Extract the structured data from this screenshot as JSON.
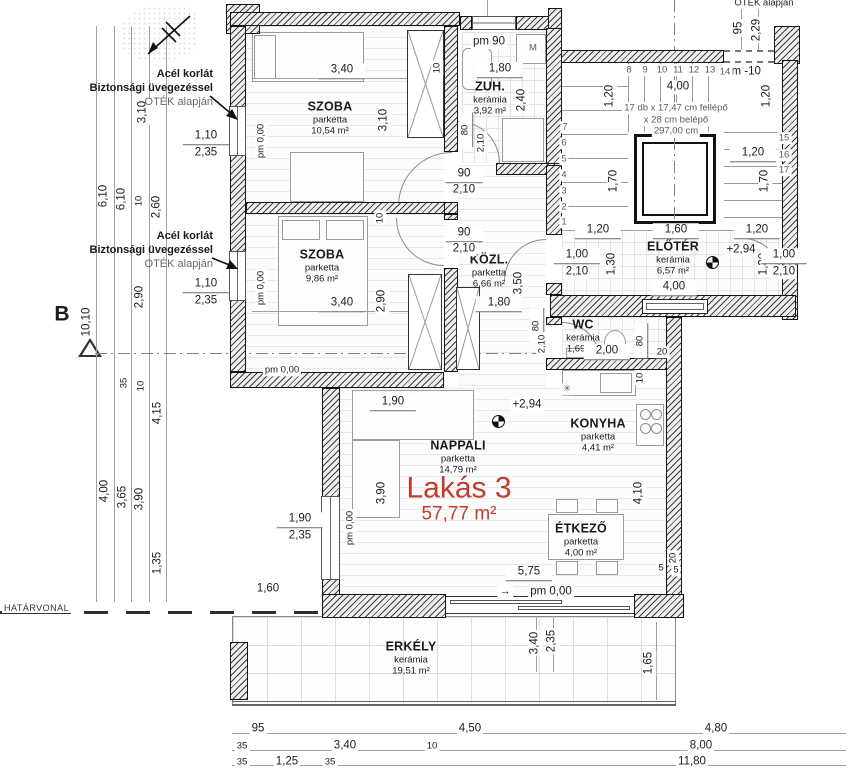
{
  "plan": {
    "unit_label": "Lakás 3",
    "unit_area": "57,77 m²",
    "accent_color": "#c13b2e"
  },
  "rooms": [
    {
      "name": "SZOBA",
      "material": "parketta",
      "area": "10,54 m²"
    },
    {
      "name": "ZUH.",
      "material": "kerámia",
      "area": "3,92 m²"
    },
    {
      "name": "SZOBA",
      "material": "parketta",
      "area": "9,86 m²"
    },
    {
      "name": "KÖZL.",
      "material": "parketta",
      "area": "6,66 m²"
    },
    {
      "name": "ELŐTÉR",
      "material": "kerámia",
      "area": "6,57 m²"
    },
    {
      "name": "WC",
      "material": "kerámia",
      "area": "1,69 m²"
    },
    {
      "name": "NAPPALI",
      "material": "parketta",
      "area": "14,79 m²"
    },
    {
      "name": "KONYHA",
      "material": "parketta",
      "area": "4,41 m²"
    },
    {
      "name": "ÉTKEZŐ",
      "material": "parketta",
      "area": "4,00 m²"
    },
    {
      "name": "ERKÉLY",
      "material": "kerámia",
      "area": "19,51 m²"
    }
  ],
  "annotations": {
    "railing_note_top": {
      "l1": "Acél korlát",
      "l2": "Biztonsági üvegezéssel",
      "l3": "OTÉK alapján"
    },
    "railing_note_mid": {
      "l1": "Acél korlát",
      "l2": "Biztonsági üvegezéssel",
      "l3": "OTÉK alapján"
    },
    "boundary_line": "HATÁRVONAL",
    "corner_note": "OTÉK alapján"
  },
  "dims": [
    {
      "t": "3,10",
      "x": 143,
      "y": 112,
      "r": 1
    },
    {
      "t": "6,10",
      "x": 104,
      "y": 196,
      "r": 1
    },
    {
      "t": "6,10",
      "x": 122,
      "y": 199,
      "r": 1
    },
    {
      "t": "10",
      "x": 139,
      "y": 201,
      "r": 1,
      "s": 1
    },
    {
      "t": "2,60",
      "x": 157,
      "y": 207,
      "r": 1
    },
    {
      "t": "2,90",
      "x": 140,
      "y": 297,
      "r": 1
    },
    {
      "t": "10,10",
      "x": 87,
      "y": 322,
      "r": 1
    },
    {
      "t": "B",
      "x": 62,
      "y": 314,
      "b": 1
    },
    {
      "t": "35",
      "x": 124,
      "y": 383,
      "r": 1,
      "s": 1
    },
    {
      "t": "10",
      "x": 141,
      "y": 386,
      "r": 1,
      "s": 1
    },
    {
      "t": "4,15",
      "x": 158,
      "y": 413,
      "r": 1
    },
    {
      "t": "4,00",
      "x": 105,
      "y": 491,
      "r": 1
    },
    {
      "t": "3,65",
      "x": 123,
      "y": 497,
      "r": 1
    },
    {
      "t": "3,90",
      "x": 140,
      "y": 499,
      "r": 1
    },
    {
      "t": "1,35",
      "x": 158,
      "y": 563,
      "r": 1
    },
    {
      "t": "1,60",
      "x": 268,
      "y": 589
    },
    {
      "t": "1,10",
      "x": 206,
      "y": 137,
      "u": 1
    },
    {
      "t": "2,35",
      "x": 206,
      "y": 153
    },
    {
      "t": "1,10",
      "x": 206,
      "y": 285,
      "u": 1
    },
    {
      "t": "2,35",
      "x": 206,
      "y": 301
    },
    {
      "t": "pm 0,00",
      "x": 261,
      "y": 141,
      "r": 1,
      "s": 1
    },
    {
      "t": "pm 0,00",
      "x": 261,
      "y": 288,
      "r": 1,
      "s": 1
    },
    {
      "t": "pm 0,00",
      "x": 282,
      "y": 370,
      "s": 1
    },
    {
      "t": "pm 0,00",
      "x": 350,
      "y": 528,
      "r": 1,
      "s": 1
    },
    {
      "t": "3,40",
      "x": 342,
      "y": 71,
      "u": 1
    },
    {
      "t": "3,10",
      "x": 384,
      "y": 120,
      "r": 1
    },
    {
      "t": "10",
      "x": 437,
      "y": 68,
      "r": 1,
      "s": 1
    },
    {
      "t": "pm 90",
      "x": 489,
      "y": 42
    },
    {
      "t": "M",
      "x": 533,
      "y": 48,
      "s": 1,
      "g": 1
    },
    {
      "t": "1,80",
      "x": 500,
      "y": 70,
      "u": 1
    },
    {
      "t": "2,40",
      "x": 522,
      "y": 100,
      "r": 1
    },
    {
      "t": "80",
      "x": 466,
      "y": 130,
      "r": 1,
      "s": 1,
      "u": 1
    },
    {
      "t": "2,10",
      "x": 481,
      "y": 143,
      "r": 1,
      "s": 1
    },
    {
      "t": "90",
      "x": 464,
      "y": 175,
      "u": 1
    },
    {
      "t": "2,10",
      "x": 464,
      "y": 190
    },
    {
      "t": "95",
      "x": 739,
      "y": 28,
      "r": 1
    },
    {
      "t": "2,29",
      "x": 757,
      "y": 30,
      "r": 1
    },
    {
      "t": "OTÉK alapján",
      "x": 764,
      "y": 3,
      "s": 1
    },
    {
      "t": "pm -10",
      "x": 743,
      "y": 72
    },
    {
      "t": "4,00",
      "x": 678,
      "y": 87
    },
    {
      "t": "1,20",
      "x": 610,
      "y": 96,
      "r": 1
    },
    {
      "t": "1,20",
      "x": 767,
      "y": 96,
      "r": 1
    },
    {
      "t": "17 db x 17,47 cm fellépő",
      "x": 676,
      "y": 108,
      "s": 1,
      "g": 1
    },
    {
      "t": "x 28 cm belépő",
      "x": 676,
      "y": 120,
      "s": 1,
      "g": 1
    },
    {
      "t": "297,00 cm",
      "x": 676,
      "y": 131,
      "s": 1,
      "g": 1
    },
    {
      "t": "8",
      "x": 629,
      "y": 70,
      "s": 1,
      "g": 1
    },
    {
      "t": "9",
      "x": 645,
      "y": 70,
      "s": 1,
      "g": 1
    },
    {
      "t": "10",
      "x": 662,
      "y": 70,
      "s": 1,
      "g": 1
    },
    {
      "t": "11",
      "x": 678,
      "y": 70,
      "s": 1,
      "g": 1
    },
    {
      "t": "12",
      "x": 694,
      "y": 70,
      "s": 1,
      "g": 1
    },
    {
      "t": "13",
      "x": 710,
      "y": 70,
      "s": 1,
      "g": 1
    },
    {
      "t": "14",
      "x": 725,
      "y": 72,
      "s": 1,
      "g": 1
    },
    {
      "t": "7",
      "x": 565,
      "y": 127,
      "s": 1,
      "g": 1
    },
    {
      "t": "6",
      "x": 564,
      "y": 143,
      "s": 1,
      "g": 1
    },
    {
      "t": "5",
      "x": 564,
      "y": 159,
      "s": 1,
      "g": 1
    },
    {
      "t": "4",
      "x": 564,
      "y": 175,
      "s": 1,
      "g": 1
    },
    {
      "t": "3",
      "x": 564,
      "y": 191,
      "s": 1,
      "g": 1
    },
    {
      "t": "2",
      "x": 564,
      "y": 207,
      "s": 1,
      "g": 1
    },
    {
      "t": "1",
      "x": 564,
      "y": 222,
      "s": 1,
      "g": 1
    },
    {
      "t": "15",
      "x": 784,
      "y": 138,
      "s": 1,
      "g": 1
    },
    {
      "t": "16",
      "x": 784,
      "y": 155,
      "s": 1,
      "g": 1
    },
    {
      "t": "17",
      "x": 784,
      "y": 170,
      "s": 1,
      "g": 1
    },
    {
      "t": "1,70",
      "x": 614,
      "y": 181,
      "r": 1
    },
    {
      "t": "1,70",
      "x": 765,
      "y": 181,
      "r": 1
    },
    {
      "t": "1,20",
      "x": 753,
      "y": 154,
      "u": 1
    },
    {
      "t": "1,20",
      "x": 598,
      "y": 231,
      "u": 1
    },
    {
      "t": "1,60",
      "x": 676,
      "y": 231,
      "u": 1
    },
    {
      "t": "1,20",
      "x": 757,
      "y": 231,
      "u": 1
    },
    {
      "t": "+2,94",
      "x": 741,
      "y": 250
    },
    {
      "t": "1,00",
      "x": 577,
      "y": 256,
      "u": 1
    },
    {
      "t": "2,10",
      "x": 577,
      "y": 272
    },
    {
      "t": "1,30",
      "x": 612,
      "y": 264,
      "r": 1
    },
    {
      "t": "1,30",
      "x": 764,
      "y": 264,
      "r": 1
    },
    {
      "t": "1,00",
      "x": 784,
      "y": 256,
      "u": 1
    },
    {
      "t": "2,10",
      "x": 784,
      "y": 272
    },
    {
      "t": "4,00",
      "x": 674,
      "y": 288,
      "u": 1
    },
    {
      "t": "10",
      "x": 380,
      "y": 218,
      "r": 1,
      "s": 1
    },
    {
      "t": "3,40",
      "x": 342,
      "y": 304,
      "u": 1
    },
    {
      "t": "2,90",
      "x": 382,
      "y": 301,
      "r": 1
    },
    {
      "t": "90",
      "x": 464,
      "y": 234,
      "u": 1
    },
    {
      "t": "2,10",
      "x": 464,
      "y": 249
    },
    {
      "t": "1,80",
      "x": 499,
      "y": 304,
      "u": 1
    },
    {
      "t": "3,50",
      "x": 519,
      "y": 283,
      "r": 1
    },
    {
      "t": "80",
      "x": 537,
      "y": 326,
      "r": 1,
      "s": 1,
      "u": 1
    },
    {
      "t": "2,10",
      "x": 542,
      "y": 344,
      "r": 1,
      "s": 1
    },
    {
      "t": "2,00",
      "x": 607,
      "y": 352,
      "u": 1
    },
    {
      "t": "80",
      "x": 641,
      "y": 341,
      "r": 1,
      "s": 1,
      "u": 1
    },
    {
      "t": "20",
      "x": 662,
      "y": 352,
      "s": 1
    },
    {
      "t": "10",
      "x": 640,
      "y": 378,
      "r": 1,
      "s": 1
    },
    {
      "t": "✳",
      "x": 567,
      "y": 389,
      "s": 1,
      "g": 1
    },
    {
      "t": "1,90",
      "x": 393,
      "y": 403,
      "u": 1
    },
    {
      "t": "+2,94",
      "x": 527,
      "y": 405
    },
    {
      "t": "3,90",
      "x": 382,
      "y": 493,
      "r": 1
    },
    {
      "t": "1,90",
      "x": 300,
      "y": 520,
      "u": 1
    },
    {
      "t": "2,35",
      "x": 300,
      "y": 536
    },
    {
      "t": "4,10",
      "x": 639,
      "y": 493,
      "r": 1
    },
    {
      "t": "5,75",
      "x": 529,
      "y": 573,
      "u": 1
    },
    {
      "t": "5",
      "x": 661,
      "y": 568,
      "s": 1
    },
    {
      "t": "20",
      "x": 673,
      "y": 558,
      "r": 1,
      "s": 1
    },
    {
      "t": "5",
      "x": 676,
      "y": 570,
      "s": 1
    },
    {
      "t": "→",
      "x": 505,
      "y": 592
    },
    {
      "t": "pm 0,00",
      "x": 551,
      "y": 592
    },
    {
      "t": "3,40",
      "x": 535,
      "y": 643,
      "r": 1
    },
    {
      "t": "2,35",
      "x": 552,
      "y": 641,
      "r": 1
    },
    {
      "t": "1,65",
      "x": 649,
      "y": 663,
      "r": 1
    },
    {
      "t": "95",
      "x": 258,
      "y": 729
    },
    {
      "t": "4,50",
      "x": 470,
      "y": 729
    },
    {
      "t": "4,80",
      "x": 716,
      "y": 729
    },
    {
      "t": "35",
      "x": 242,
      "y": 746,
      "s": 1
    },
    {
      "t": "3,40",
      "x": 345,
      "y": 746
    },
    {
      "t": "10",
      "x": 432,
      "y": 746,
      "s": 1
    },
    {
      "t": "8,00",
      "x": 701,
      "y": 746
    },
    {
      "t": "35",
      "x": 242,
      "y": 762,
      "s": 1
    },
    {
      "t": "1,25",
      "x": 287,
      "y": 762
    },
    {
      "t": "35",
      "x": 330,
      "y": 762,
      "s": 1
    },
    {
      "t": "11,80",
      "x": 692,
      "y": 762
    }
  ]
}
